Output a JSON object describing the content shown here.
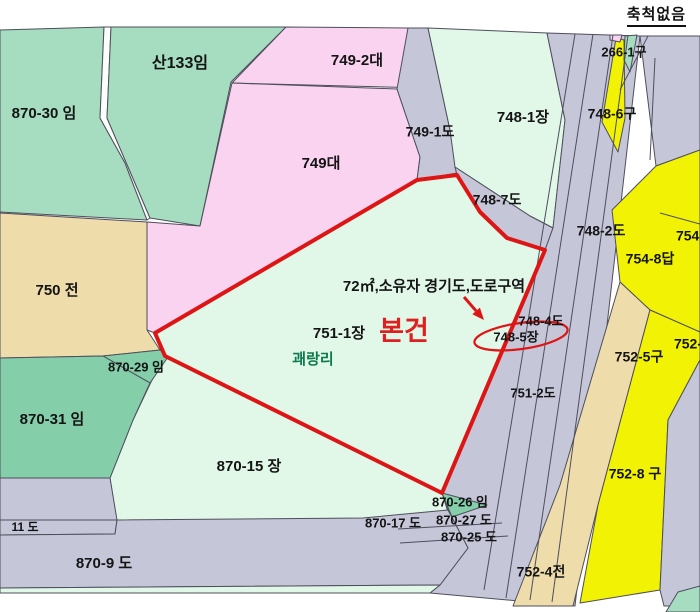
{
  "scale_note": "축척없음",
  "map": {
    "width": 700,
    "height": 612,
    "background": "#ffffff",
    "stroke_color": "#4e4e5c",
    "default_label_color": "#141414",
    "colors": {
      "green_medium": "#a6ddc0",
      "green_dark": "#84cfaa",
      "mint": "#e1f8e9",
      "pink": "#fad3f0",
      "road_gray": "#c6c6d9",
      "yellow": "#f2f204",
      "tan": "#eeddab",
      "highlight_red": "#de1515"
    },
    "parcels": [
      {
        "name": "870-30-im",
        "fill": "#a6ddc0",
        "points": "0,30 104,27 100,118 125,163 147,220 0,212"
      },
      {
        "name": "road-sliver",
        "fill": "#fbfdfb",
        "points": "104,27 111,27 107,118 150,218 147,220 125,163 100,118"
      },
      {
        "name": "san-133-im",
        "fill": "#a6ddc0",
        "points": "111,27 286,27 231,82 200,226 150,218 107,118"
      },
      {
        "name": "749-2-dae",
        "fill": "#fad3f0",
        "points": "286,27 408,28 425,88 232,83"
      },
      {
        "name": "749-dae",
        "fill": "#fad3f0",
        "points": "232,83 397,89 420,157 417,180 155,333 147,330 147,222 200,226"
      },
      {
        "name": "749-1-do",
        "fill": "#c6c6d9",
        "points": "408,28 428,28 450,130 457,173 417,180 420,157 397,89"
      },
      {
        "name": "748-1-jang",
        "fill": "#e1f8e9",
        "points": "428,28 547,33 565,120 553,228 530,216 455,167 450,130"
      },
      {
        "name": "748-7-do",
        "fill": "#c6c6d9",
        "points": "455,167 530,216 553,228 545,250 507,238 480,212 457,175"
      },
      {
        "name": "road-bundle",
        "fill": "#c6c6d9",
        "points": "547,33 640,36 575,606 430,593 440,585 468,548 448,510 442,493 545,250 553,228 565,120"
      },
      {
        "name": "east-road-top",
        "fill": "#c6c6d9",
        "points": "640,36 700,36 700,150 656,166"
      },
      {
        "name": "754-8-dap",
        "fill": "#f2f204",
        "points": "656,166 700,150 700,332 650,310 620,282 612,210"
      },
      {
        "name": "752-5-gu",
        "fill": "#eeddab",
        "points": "620,282 650,310 598,505 573,606 513,606 560,485"
      },
      {
        "name": "752-8-gu",
        "fill": "#f2f204",
        "points": "650,310 700,332 700,360 668,420 660,590 580,603 598,505"
      },
      {
        "name": "east-road-bottom",
        "fill": "#c6c6d9",
        "points": "700,360 700,606 664,606 660,590 668,420"
      },
      {
        "name": "corner-green",
        "fill": "#a6ddc0",
        "points": "678,592 700,586 700,612 666,612"
      },
      {
        "name": "751-1-jang-subject",
        "fill": "#e1f8e9",
        "points": "155,333 417,180 457,175 480,212 507,238 545,250 442,493 165,356"
      },
      {
        "name": "870-15-jang",
        "fill": "#e1f8e9",
        "points": "165,356 442,493 448,512 400,518 117,523 110,478 133,420 151,382"
      },
      {
        "name": "750-jeon",
        "fill": "#eeddab",
        "points": "0,213 147,222 147,330 160,350 103,356 0,358"
      },
      {
        "name": "870-29-im",
        "fill": "#84cfaa",
        "points": "103,356 160,350 168,357 150,383"
      },
      {
        "name": "870-31-im",
        "fill": "#84cfaa",
        "points": "0,358 103,356 150,383 133,420 110,478 0,478"
      },
      {
        "name": "sw-road-gray",
        "fill": "#c6c6d9",
        "points": "0,478 110,478 117,520 0,520"
      },
      {
        "name": "870-11-do",
        "fill": "#c6c6d9",
        "points": "0,520 117,520 115,534 0,535"
      },
      {
        "name": "870-9-do",
        "fill": "#c6c6d9",
        "points": "0,535 115,534 117,520 363,518 448,510 468,548 440,585 0,588"
      },
      {
        "name": "bottom-strip",
        "fill": "#e1f8e9",
        "points": "0,588 440,585 430,593 0,593"
      },
      {
        "name": "870-26-im",
        "fill": "#84cfaa",
        "points": "442,493 487,505 452,517"
      },
      {
        "name": "748-6-gu",
        "fill": "#f2f204",
        "points": "616,38 624,40 625,118 618,152 602,122"
      },
      {
        "name": "green-sliver",
        "fill": "#a6ddc0",
        "points": "625,36 637,35 630,72 624,60"
      },
      {
        "name": "pink-sliver",
        "fill": "#fad3f0",
        "points": "610,35 622,35 620,42 610,40"
      }
    ],
    "lines": [
      {
        "x1": 575,
        "y1": 34,
        "x2": 484,
        "y2": 590
      },
      {
        "x1": 593,
        "y1": 34,
        "x2": 506,
        "y2": 598
      },
      {
        "x1": 613,
        "y1": 35,
        "x2": 530,
        "y2": 600
      },
      {
        "x1": 628,
        "y1": 35,
        "x2": 552,
        "y2": 602
      },
      {
        "x1": 648,
        "y1": 36,
        "x2": 620,
        "y2": 90
      },
      {
        "x1": 655,
        "y1": 58,
        "x2": 650,
        "y2": 160
      },
      {
        "x1": 660,
        "y1": 213,
        "x2": 700,
        "y2": 224
      },
      {
        "x1": 398,
        "y1": 529,
        "x2": 502,
        "y2": 523
      },
      {
        "x1": 400,
        "y1": 543,
        "x2": 508,
        "y2": 536
      }
    ],
    "labels": [
      {
        "text": "산133임",
        "x": 180,
        "y": 64,
        "size": 16
      },
      {
        "text": "870-30 임",
        "x": 44,
        "y": 114,
        "size": 15
      },
      {
        "text": "749-2대",
        "x": 357,
        "y": 61,
        "size": 15
      },
      {
        "text": "749-1도",
        "x": 430,
        "y": 133,
        "size": 14
      },
      {
        "text": "748-1장",
        "x": 523,
        "y": 118,
        "size": 15
      },
      {
        "text": "748-6구",
        "x": 612,
        "y": 115,
        "size": 14
      },
      {
        "text": "266-1구",
        "x": 624,
        "y": 53,
        "size": 13
      },
      {
        "text": "749대",
        "x": 321,
        "y": 164,
        "size": 15
      },
      {
        "text": "748-7도",
        "x": 497,
        "y": 201,
        "size": 14
      },
      {
        "text": "748-2도",
        "x": 601,
        "y": 232,
        "size": 14
      },
      {
        "text": "754-",
        "x": 690,
        "y": 237,
        "size": 14
      },
      {
        "text": "754-8답",
        "x": 650,
        "y": 260,
        "size": 14
      },
      {
        "text": "750 전",
        "x": 57,
        "y": 291,
        "size": 15
      },
      {
        "text": "72㎡,소유자 경기도,도로구역",
        "x": 434,
        "y": 287,
        "size": 15,
        "weight": 700
      },
      {
        "text": "751-1장",
        "x": 339,
        "y": 334,
        "size": 15
      },
      {
        "text": "본건",
        "x": 404,
        "y": 333,
        "size": 27,
        "weight": 700,
        "color": "#dd2020"
      },
      {
        "text": "748-4도",
        "x": 541,
        "y": 322,
        "size": 13
      },
      {
        "text": "748-5장",
        "x": 516,
        "y": 338,
        "size": 13
      },
      {
        "text": "괘랑리",
        "x": 313,
        "y": 360,
        "size": 15,
        "weight": 700,
        "color": "#0c7a4e"
      },
      {
        "text": "870-29 임",
        "x": 136,
        "y": 368,
        "size": 13
      },
      {
        "text": "751-2도",
        "x": 533,
        "y": 394,
        "size": 13
      },
      {
        "text": "752-5구",
        "x": 639,
        "y": 358,
        "size": 14
      },
      {
        "text": "752-",
        "x": 688,
        "y": 345,
        "size": 14
      },
      {
        "text": "870-31 임",
        "x": 52,
        "y": 420,
        "size": 15
      },
      {
        "text": "870-15 장",
        "x": 249,
        "y": 467,
        "size": 15
      },
      {
        "text": "752-8 구",
        "x": 635,
        "y": 475,
        "size": 14
      },
      {
        "text": "870-26 임",
        "x": 460,
        "y": 503,
        "size": 13
      },
      {
        "text": "870-17 도",
        "x": 393,
        "y": 524,
        "size": 13
      },
      {
        "text": "870-27 도",
        "x": 464,
        "y": 521,
        "size": 13
      },
      {
        "text": "870-25 도",
        "x": 469,
        "y": 538,
        "size": 13
      },
      {
        "text": "11 도",
        "x": 25,
        "y": 528,
        "size": 12
      },
      {
        "text": "870-9 도",
        "x": 104,
        "y": 564,
        "size": 15
      },
      {
        "text": "752-4전",
        "x": 541,
        "y": 573,
        "size": 14
      }
    ],
    "highlight": {
      "color": "#de1515",
      "outline_points": "155,333 417,180 457,175 480,212 507,238 545,250 442,493 165,356",
      "outline_width": 4,
      "ellipse": {
        "cx": 521,
        "cy": 336,
        "rx": 47,
        "ry": 13,
        "rotate": -8
      },
      "arrow": {
        "x1": 464,
        "y1": 297,
        "x2": 484,
        "y2": 320
      }
    }
  }
}
